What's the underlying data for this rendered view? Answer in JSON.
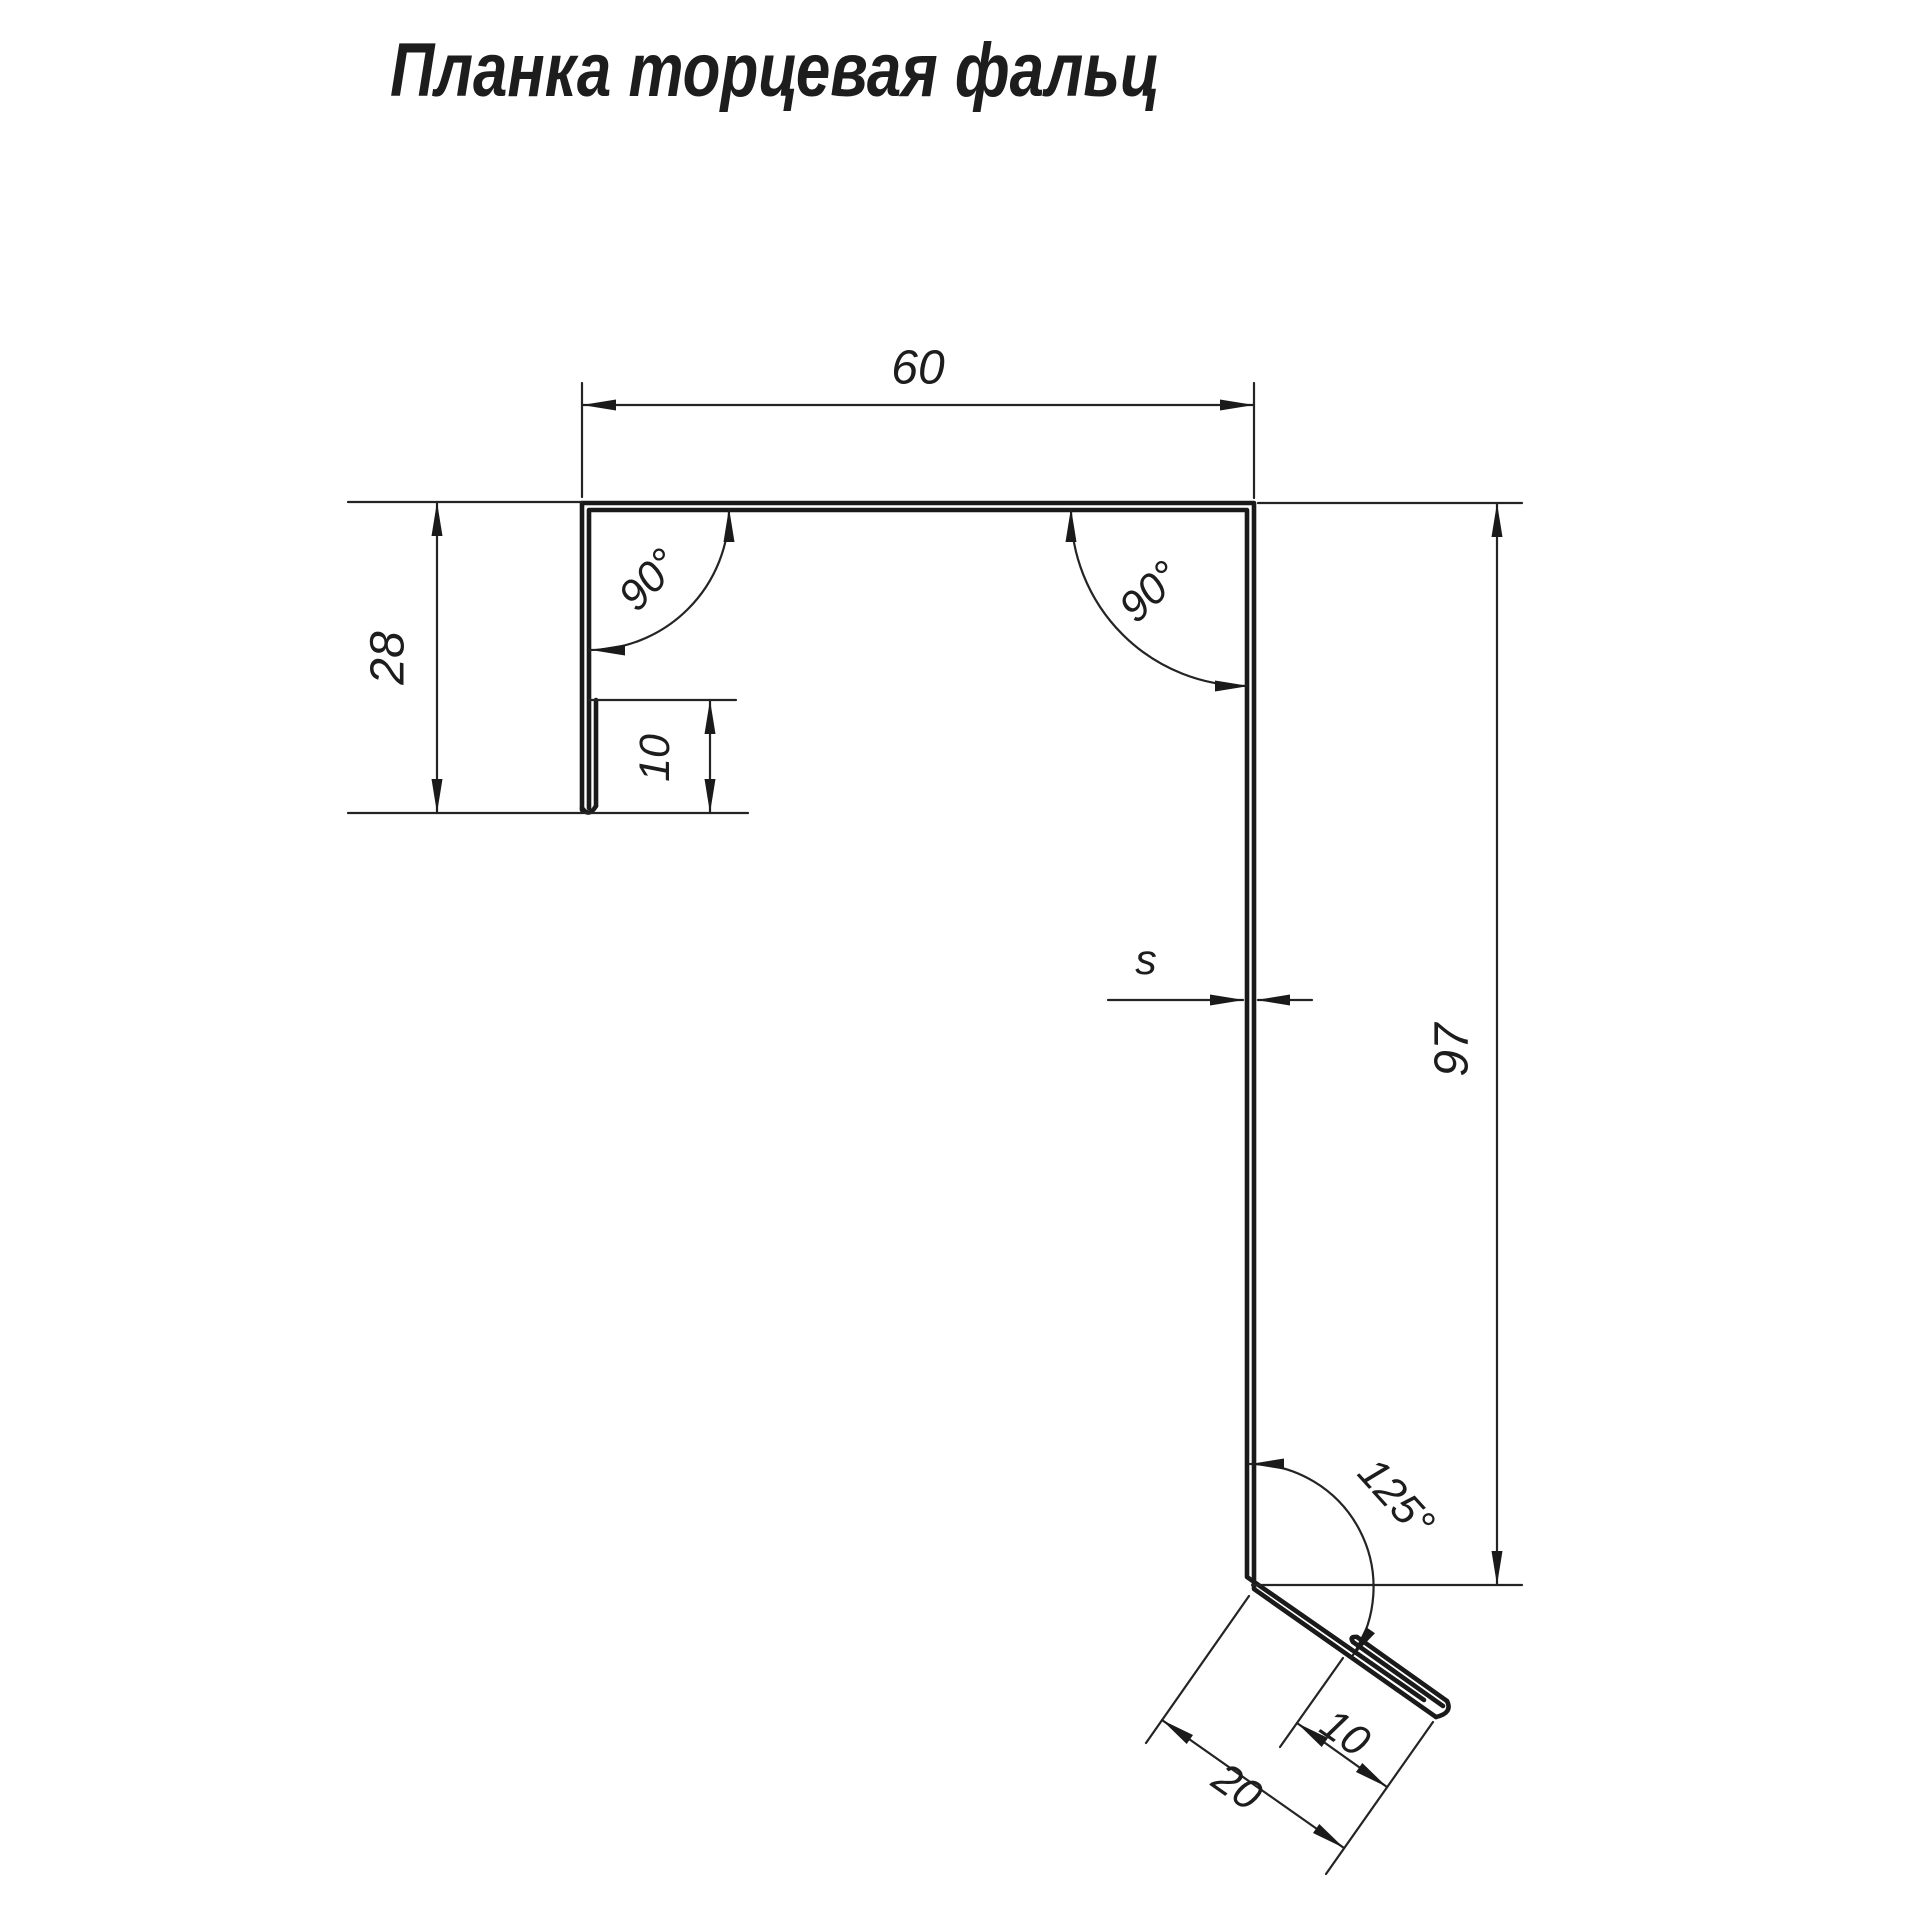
{
  "title": "Планка торцевая фальц",
  "colors": {
    "background": "#ffffff",
    "line": "#1a1a1a",
    "text": "#1d1d1d"
  },
  "profile": {
    "name": "Планка торцевая фальц",
    "dimensions_mm": {
      "top_flange_width": 60,
      "left_leg_height": 28,
      "left_hem_length": 10,
      "right_leg_height": 97,
      "bottom_kick_length": 20,
      "bottom_kick_hem": 10
    },
    "thickness_symbol": "s",
    "angles": {
      "top_left": "90°",
      "top_right": "90°",
      "bottom_kick": "125°"
    }
  },
  "labels": {
    "dim_top_width": "60",
    "dim_left_height": "28",
    "dim_left_hem": "10",
    "dim_right_height": "97",
    "dim_thickness": "s",
    "angle_top_left": "90°",
    "angle_top_right": "90°",
    "angle_bottom": "125°",
    "dim_kick_hem": "10",
    "dim_kick_length": "20"
  }
}
